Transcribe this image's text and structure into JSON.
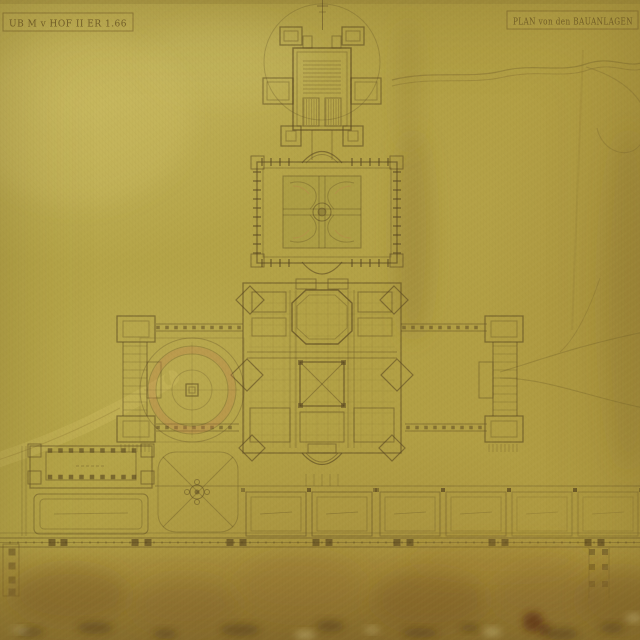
{
  "document": {
    "left_cartouche_text": "UB M v HOF II ER 1.66",
    "right_cartouche_text": "PLAN von den BAUANLAGEN"
  },
  "palette": {
    "paper": "#b3a246",
    "paper_light": "#cfc06a",
    "ink": "#54421f",
    "ring_accent": "#c2784e",
    "road_light": "#cdbc5e",
    "stain_mid": "#8a6a2c",
    "stain_dark": "#7d5c26",
    "stain_burn": "#5a2a16",
    "speck_dark": "#4a3512",
    "spot_light": "#e3d795"
  }
}
